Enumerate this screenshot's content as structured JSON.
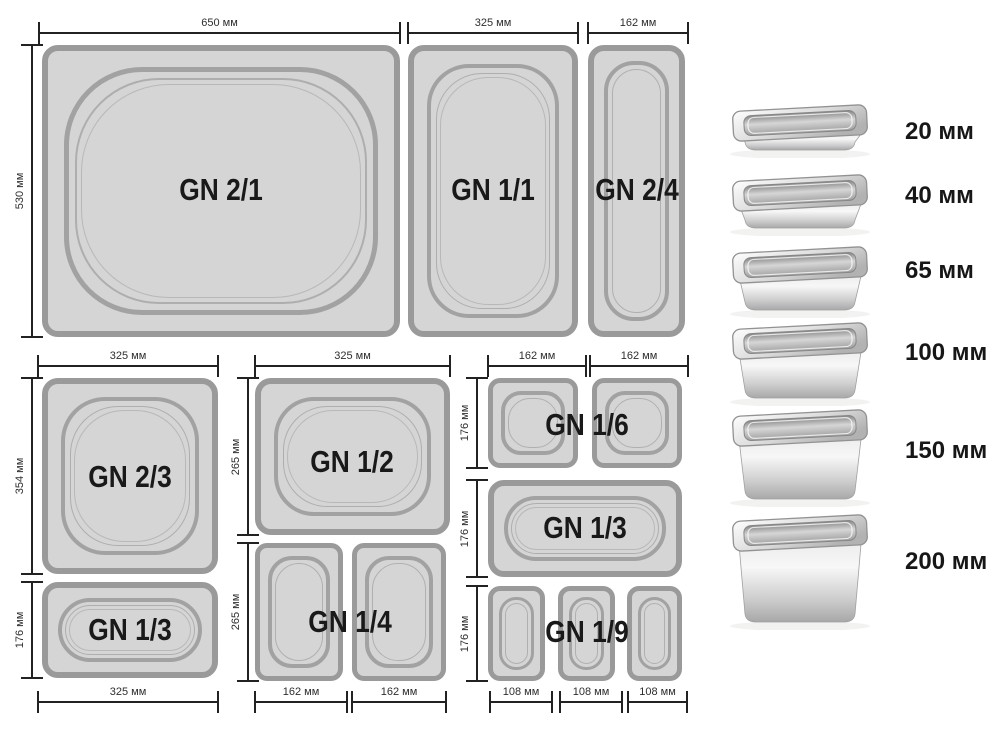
{
  "groups": [
    {
      "name": "full-size-row",
      "top_dims": [
        "650 мм",
        "325 мм",
        "162 мм"
      ],
      "left_dims": [
        "530 мм"
      ],
      "pans": [
        "GN 2/1",
        "GN 1/1",
        "GN 2/4"
      ]
    },
    {
      "name": "two-thirds-column",
      "top_dims": [
        "325 мм"
      ],
      "left_dims": [
        "354 мм",
        "176 мм"
      ],
      "bottom_dims": [
        "325 мм"
      ],
      "pans": [
        "GN 2/3",
        "GN 1/3"
      ]
    },
    {
      "name": "half-column",
      "top_dims": [
        "325 мм"
      ],
      "left_dims": [
        "265 мм",
        "265 мм"
      ],
      "bottom_dims": [
        "162 мм",
        "162 мм"
      ],
      "pans": [
        "GN 1/2",
        "GN 1/4"
      ]
    },
    {
      "name": "sixth-column",
      "top_dims": [
        "162 мм",
        "162 мм"
      ],
      "left_dims": [
        "176 мм",
        "176 мм",
        "176 мм"
      ],
      "bottom_dims": [
        "108 мм",
        "108 мм",
        "108 мм"
      ],
      "pans": [
        "GN 1/6",
        "GN 1/3",
        "GN 1/9"
      ]
    }
  ],
  "depth_rows": [
    {
      "label": "20 мм"
    },
    {
      "label": "40 мм"
    },
    {
      "label": "65 мм"
    },
    {
      "label": "100 мм"
    },
    {
      "label": "150 мм"
    },
    {
      "label": "200 мм"
    }
  ],
  "colors": {
    "pan_fill": "#d5d5d5",
    "pan_border": "#9a9a9a",
    "dim_line": "#222222",
    "label_text": "#191919"
  }
}
